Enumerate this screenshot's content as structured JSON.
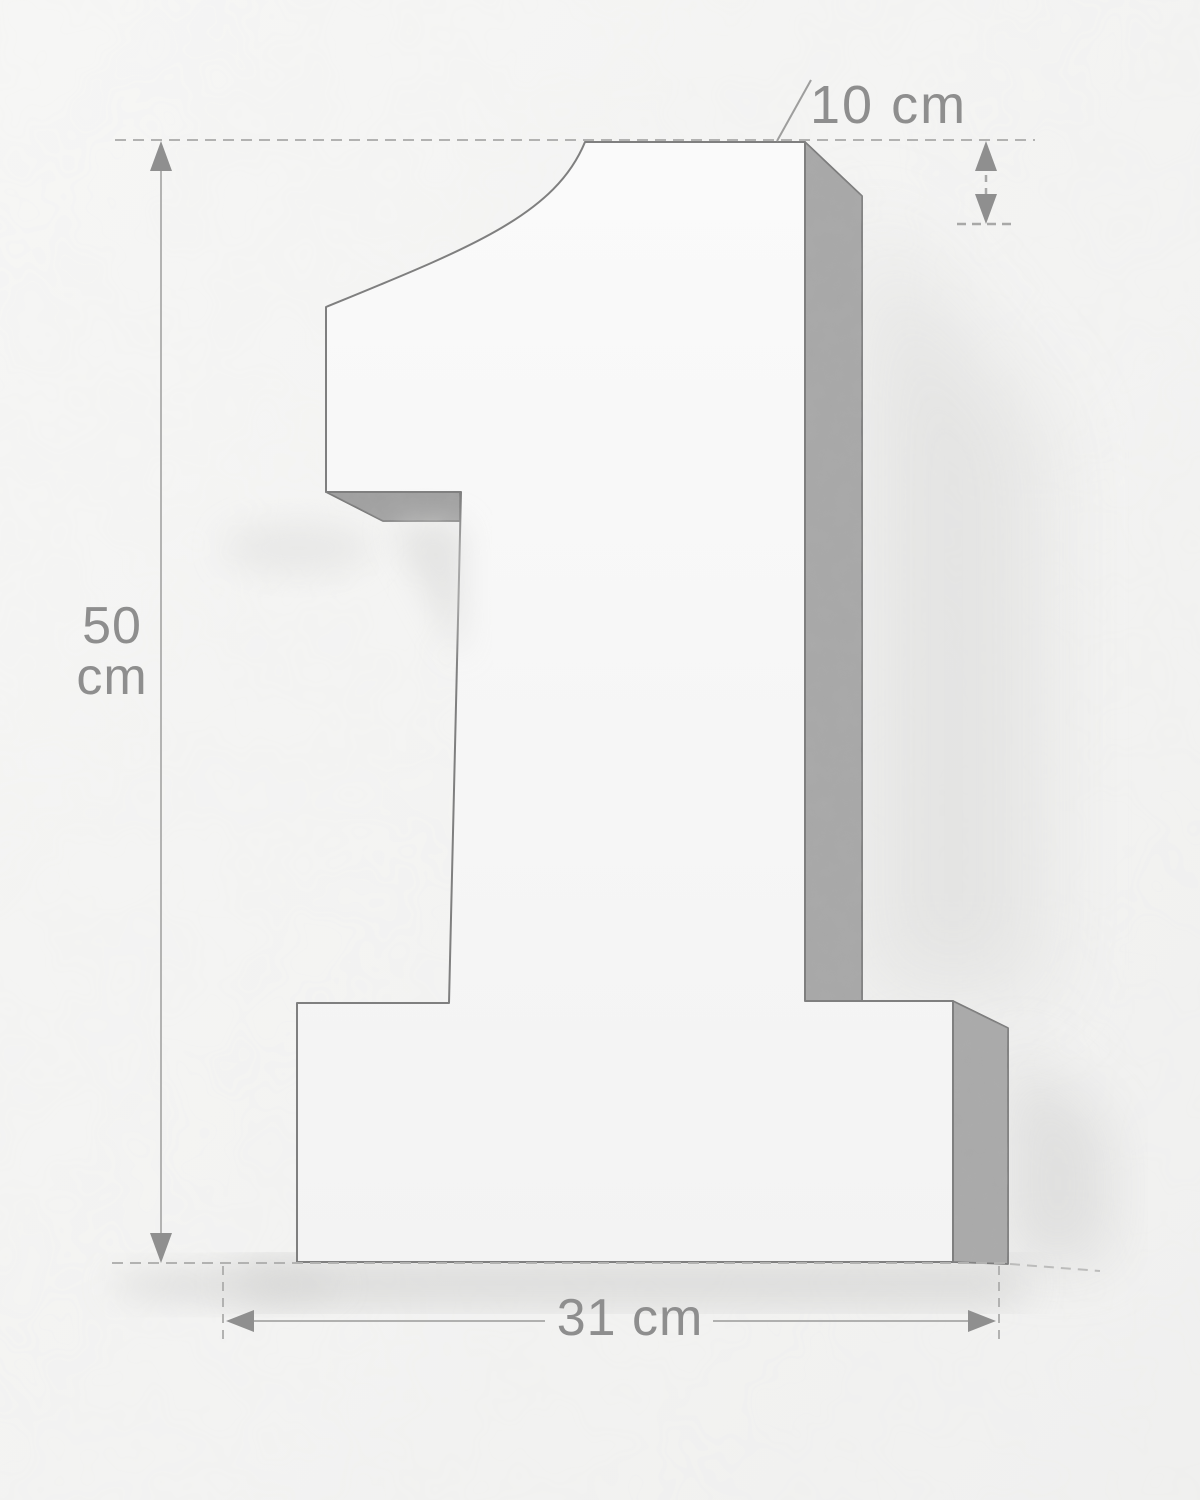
{
  "figure": {
    "subject_numeral": "1",
    "description": "3D extruded numeral sign with dimension annotations"
  },
  "labels": {
    "height_value": "50",
    "height_unit": "cm",
    "width": "31 cm",
    "depth": "10 cm"
  },
  "colors": {
    "background": "#f5f5f4",
    "front_face": "#f8f8f8",
    "side_face": "#a7a7a7",
    "outline": "#7f7f7f",
    "dimension_line": "#aeaeae",
    "arrow_fill": "#8f8f8f",
    "label_text": "#8e8e8e"
  }
}
